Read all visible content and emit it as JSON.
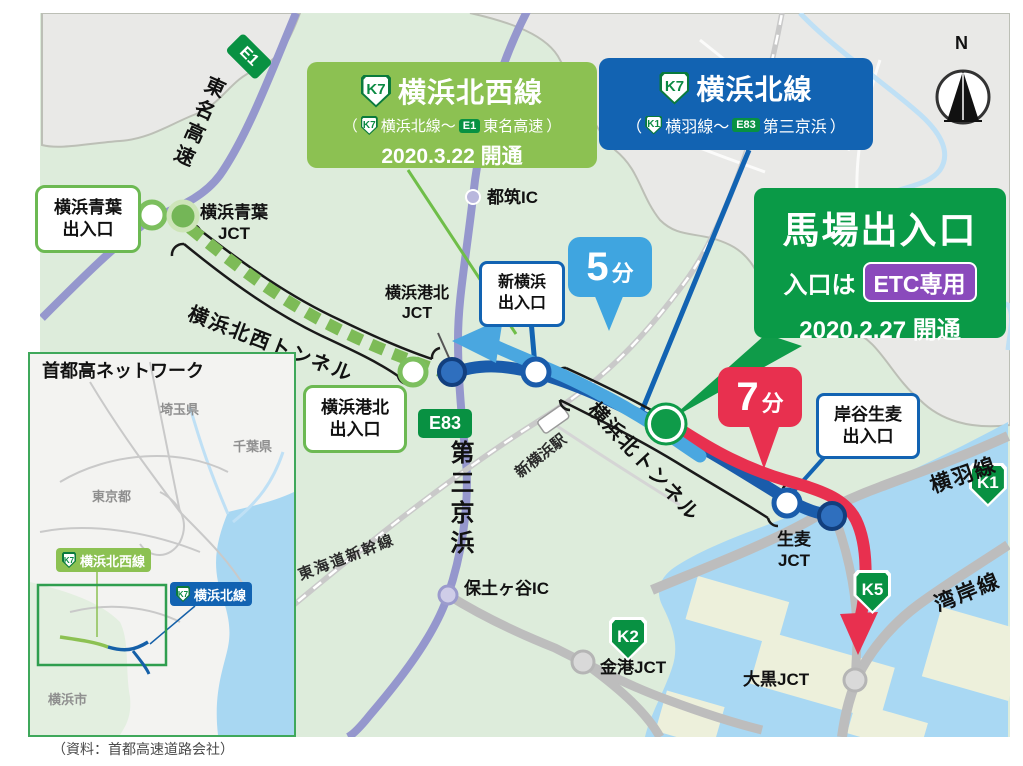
{
  "colors": {
    "map_bg": "#ddecdb",
    "urban_grey": "#e9e9e7",
    "water": "#a9d8f3",
    "land_patch": "#edf0db",
    "purple_road": "#9597cd",
    "grey_road": "#bdbdbd",
    "railway": "#c9c9c9",
    "nw_line_green": "#8cc152",
    "north_line_blue": "#1263b2",
    "baba_green": "#0a9a47",
    "etc_purple": "#8a4abc",
    "route_dark_blue": "#1a5cab",
    "route_light_blue": "#4aa7e0",
    "route_red": "#e8304f",
    "tunnel_dash_green": "#7dbb57",
    "shield_green": "#089142",
    "min5_blue": "#3fa5e0",
    "min7_red": "#e8304f"
  },
  "boxes": {
    "nw": {
      "badge": "K7",
      "title": "横浜北西線",
      "sub_open": "（",
      "sub_badge1": "K7",
      "sub_t1": "横浜北線～",
      "sub_badge2": "E1",
      "sub_t2": "東名高速",
      "sub_close": "）",
      "date": "2020.3.22 開通"
    },
    "north": {
      "badge": "K7",
      "title": "横浜北線",
      "sub_open": "（",
      "sub_badge1": "K1",
      "sub_t1": "横羽線～",
      "sub_badge2": "E83",
      "sub_t2": "第三京浜",
      "sub_close": "）"
    },
    "baba": {
      "title": "馬場出入口",
      "pre": "入口は",
      "etc": "ETC専用",
      "date": "2020.2.27 開通"
    }
  },
  "labels": {
    "aoba_exit": "横浜青葉\n出入口",
    "aoba_jct": "横浜青葉\nJCT",
    "e1": "E1",
    "tomei": "東名高速",
    "nw_tunnel": "横浜北西トンネル",
    "kohoku_jct": "横浜港北\nJCT",
    "kohoku_exit": "横浜港北\n出入口",
    "e83": "E83",
    "daisan": "第三京浜",
    "tsuzuki": "都筑IC",
    "shinyoko_exit": "新横浜\n出入口",
    "min5_num": "5",
    "min5_unit": "分",
    "min7_num": "7",
    "min7_unit": "分",
    "shinyoko_sta": "新横浜駅",
    "kita_tunnel": "横浜北トンネル",
    "tokaido": "東海道新幹線",
    "hodogaya": "保土ヶ谷IC",
    "k2": "K2",
    "k5": "K5",
    "k1": "K1",
    "b": "B",
    "kinko": "金港JCT",
    "daikoku": "大黒JCT",
    "namamugi": "生麦\nJCT",
    "yokohane": "横羽線",
    "wangan": "湾岸線",
    "kishiya": "岸谷生麦\n出入口",
    "compass_n": "N"
  },
  "inset": {
    "title": "首都高ネットワーク",
    "prefectures": {
      "saitama": "埼玉県",
      "chiba": "千葉県",
      "tokyo": "東京都",
      "yokohama": "横浜市"
    },
    "legend_green_badge": "K7",
    "legend_green": "横浜北西線",
    "legend_blue_badge": "K7",
    "legend_blue": "横浜北線"
  },
  "caption": "（資料：首都高速道路会社）"
}
